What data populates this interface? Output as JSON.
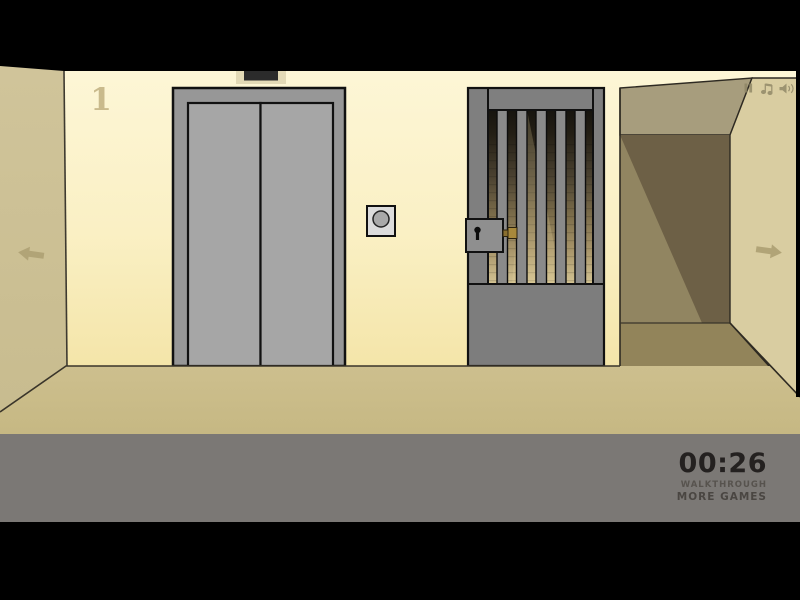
{
  "scene": {
    "floor_label": "1"
  },
  "hud": {
    "timer": "00:26",
    "walkthrough_label": "WALKTHROUGH",
    "more_games_label": "MORE GAMES"
  },
  "icons": {
    "left_nav": "left-arrow-icon",
    "right_nav": "right-arrow-icon",
    "pause": "pause-icon",
    "music": "music-note-icon",
    "sound": "speaker-icon",
    "call_button": "elevator-call-button",
    "keyhole": "keyhole-icon"
  },
  "colors": {
    "front_wall": "#FAF0C4",
    "left_wall": "#CDC197",
    "right_wall": "#D9CDA1",
    "floor": "#C9BB89",
    "corridor_back": "#6D6046",
    "elevator_gray": "#9A9A9A",
    "gate_gray": "#7F7F7F",
    "hud_strip": "#7B7875",
    "timer_text": "#242120",
    "latch_brass": "#A8893B"
  }
}
